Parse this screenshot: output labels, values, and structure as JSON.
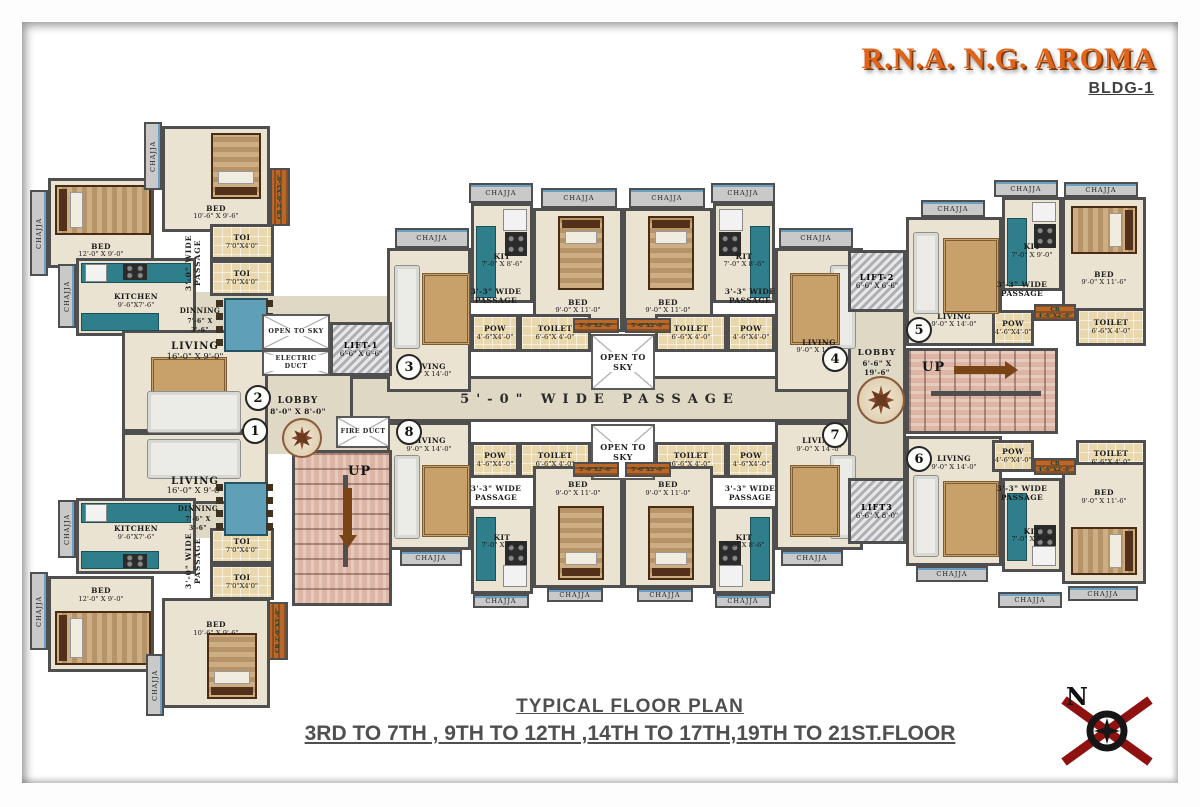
{
  "header": {
    "title": "R.N.A. N.G. AROMA",
    "building": "BLDG-1"
  },
  "footer": {
    "line1": "TYPICAL FLOOR PLAN",
    "line2": "3RD TO 7TH , 9TH TO 12TH ,14TH TO 17TH,19TH TO 21ST.FLOOR"
  },
  "compass": {
    "label": "N"
  },
  "labels": {
    "chajja": "CHAJJA",
    "open_to_sky": "OPEN TO SKY",
    "electric_duct": "ELECTRIC DUCT",
    "fire_duct": "FIRE DUCT",
    "up": "UP",
    "passage_main": "5'-0\" WIDE PASSAGE",
    "passage_33": "3'-3\" WIDE PASSAGE",
    "passage_30": "3'-0\" WIDE PASSAGE",
    "strip_5x2": "5'-0\"X2'-0\"",
    "cb_small": "CB 2'-0\"X5'-0\""
  },
  "rooms": {
    "bed_10_6": {
      "name": "BED",
      "dims": "10'-6\" X 9'-6\""
    },
    "bed_12_0": {
      "name": "BED",
      "dims": "12'-0\" X 9'-0\""
    },
    "bed_9_11": {
      "name": "BED",
      "dims": "9'-0\" X 11'-0\""
    },
    "bed_9_11_6": {
      "name": "BED",
      "dims": "9'-0\" X 11'-6\""
    },
    "kitchen": {
      "name": "KITCHEN",
      "dims": "9'-6\"X7'-6\""
    },
    "kit_8_6": {
      "name": "KIT",
      "dims": "7'-0\" X 8'-6\""
    },
    "kit_9_0": {
      "name": "KIT",
      "dims": "7'-0\" X 9'-0\""
    },
    "toi": {
      "name": "TOI",
      "dims": "7'0\"X4'0\""
    },
    "toilet": {
      "name": "TOILET",
      "dims": "6'-6\"X 4'-0\""
    },
    "pow": {
      "name": "POW",
      "dims": "4'-6\"X4'-0\""
    },
    "living_16": {
      "name": "LIVING",
      "dims": "16'-0\" X 9'-0\""
    },
    "living_9_14": {
      "name": "LIVING",
      "dims": "9'-0\" X 14'-0\""
    },
    "dinning": {
      "name": "DINNING",
      "dims": "7'-6\" X 3'-6\""
    },
    "lobby_8": {
      "name": "LOBBY",
      "dims": "8'-0\" X 8'-0\""
    },
    "lobby_19": {
      "name": "LOBBY",
      "dims": "6'-6\" X 19'-6\""
    },
    "lift1": {
      "name": "LIFT-1",
      "dims": "6'-6\" X 6'-6\""
    },
    "lift2": {
      "name": "LIFT-2",
      "dims": "6'-6\" X 6'-6\""
    },
    "lift3": {
      "name": "LIFT3",
      "dims": "6'-6\" X 8'-0\""
    },
    "cb": {
      "name": "CB",
      "dims": "4'-6\"X2'-0\""
    }
  },
  "units": {
    "u1": "1",
    "u2": "2",
    "u3": "3",
    "u4": "4",
    "u5": "5",
    "u6": "6",
    "u7": "7",
    "u8": "8"
  },
  "colors": {
    "title_accent": "#E0651A",
    "wall": "#4F4F4F",
    "kitchen_counter": "#2F7E8C",
    "cb_strip": "#B9682A",
    "stairs": "#DCB5A5"
  }
}
